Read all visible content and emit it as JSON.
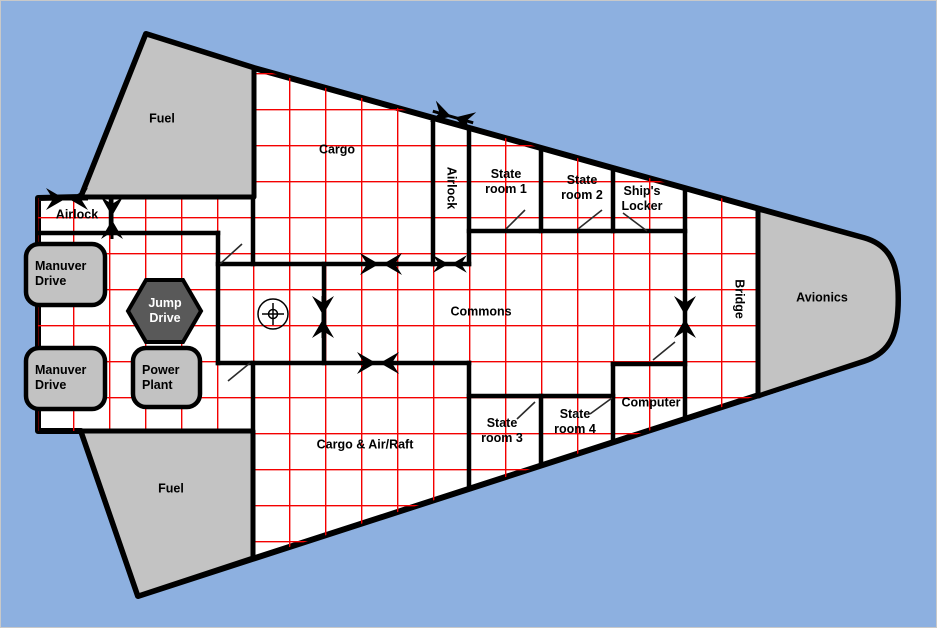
{
  "title": "Starship deck plan",
  "colors": {
    "background": "#8db0e0",
    "hull_fill": "#ffffff",
    "hull_stroke": "#000000",
    "grid": "#f40000",
    "tank_fill": "#c3c3c3",
    "equipment_fill": "#c2c2c2",
    "jump_drive_fill": "#595959",
    "jump_drive_text": "#ffffff"
  },
  "rooms": {
    "fuel_top": "Fuel",
    "fuel_bottom": "Fuel",
    "airlock_left": "Airlock",
    "airlock_top": "Airlock",
    "cargo": "Cargo",
    "stateroom1": "State\nroom 1",
    "stateroom2": "State\nroom 2",
    "ships_locker": "Ship's\nLocker",
    "commons": "Commons",
    "bridge": "Bridge",
    "avionics": "Avionics",
    "cargo_airraft": "Cargo & Air/Raft",
    "stateroom3": "State\nroom 3",
    "stateroom4": "State\nroom 4",
    "computer": "Computer"
  },
  "equipment": {
    "manuver_drive_1": "Manuver\nDrive",
    "manuver_drive_2": "Manuver\nDrive",
    "jump_drive": "Jump\nDrive",
    "power_plant": "Power\nPlant"
  },
  "symbols": {
    "door": "bowtie-door",
    "sliding_door": "diagonal-line-door",
    "turret": "circle-crosshair"
  }
}
